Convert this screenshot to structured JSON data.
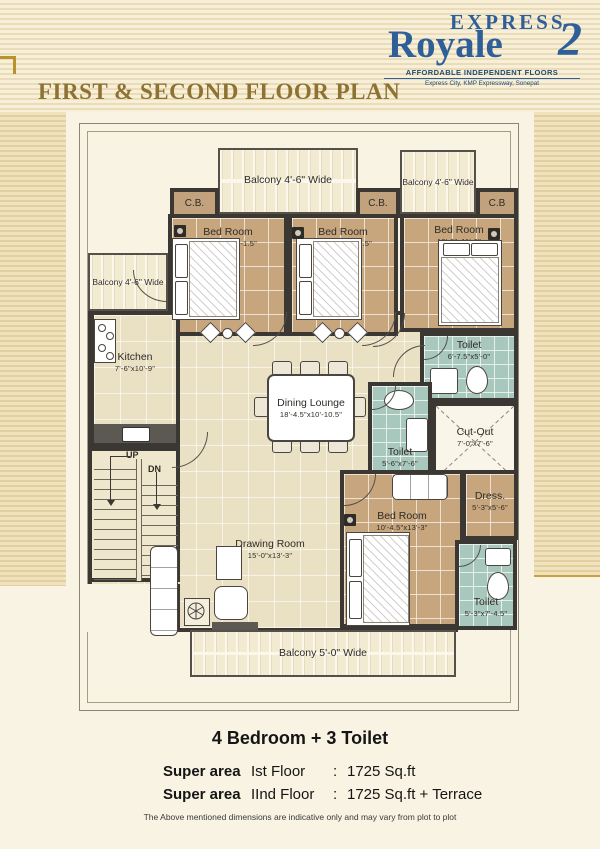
{
  "brand": {
    "line1": "EXPRESS",
    "line2": "Royale",
    "line2_suffix": "2",
    "tagline": "AFFORDABLE INDEPENDENT FLOORS",
    "subtext": "Express City, KMP Expressway, Sonepat",
    "color": "#2f5f98"
  },
  "page_title": "FIRST & SECOND FLOOR PLAN",
  "title_color": "#8d7231",
  "plan": {
    "balconies": {
      "top_center": "Balcony 4'-6\" Wide",
      "top_right": "Balcony 4'-6\" Wide",
      "left": "Balcony 4'-6\" Wide",
      "bottom": "Balcony 5'-0\" Wide"
    },
    "cupboards": [
      {
        "label": "C.B."
      },
      {
        "label": "C.B."
      },
      {
        "label": "C.B"
      }
    ],
    "rooms": {
      "bedroom1": {
        "name": "Bed Room",
        "dims": "10'-4.5\"x13'-1.5\""
      },
      "bedroom2": {
        "name": "Bed Room",
        "dims": "10'-4.5\"x13'-1.5\""
      },
      "bedroom3": {
        "name": "Bed Room",
        "dims": "10'-0\"x11'-0\""
      },
      "kitchen": {
        "name": "Kitchen",
        "dims": "7'-6\"x10'-9\""
      },
      "dining": {
        "name": "Dining Lounge",
        "dims": "18'-4.5\"x10'-10.5\""
      },
      "toilet_top": {
        "name": "Toilet",
        "dims": "6'-7.5\"x5'-0\""
      },
      "toilet_mid": {
        "name": "Toilet",
        "dims": "5'-6\"x7'-6\""
      },
      "cutout": {
        "name": "Cut-Out",
        "dims": "7'-0\"x7'-6\""
      },
      "bedroom4": {
        "name": "Bed Room",
        "dims": "10'-4.5\"x13'-3\""
      },
      "dress": {
        "name": "Dress.",
        "dims": "5'-3\"x5'-6\""
      },
      "toilet_bottom": {
        "name": "Toilet",
        "dims": "5'-3\"x7'-4.5\""
      },
      "drawing": {
        "name": "Drawing Room",
        "dims": "15'-0\"x13'-3\""
      }
    },
    "stairs": {
      "up": "UP",
      "down": "DN"
    }
  },
  "summary": {
    "headline": "4 Bedroom + 3 Toilet",
    "rows": [
      {
        "label": "Super area",
        "floor": "Ist Floor",
        "sep": ":",
        "value": "1725 Sq.ft"
      },
      {
        "label": "Super area",
        "floor": "IInd Floor",
        "sep": ":",
        "value": "1725 Sq.ft + Terrace"
      }
    ],
    "disclaimer": "The Above mentioned dimensions are indicative only and may vary from plot to plot"
  },
  "colors": {
    "wall": "#3b3733",
    "bedroom_floor": "#c7a67e",
    "living_floor": "#eae1c4",
    "toilet_floor": "#a9c8bd",
    "background_stripe": "#e2d0a2",
    "gold_accent": "#c9a23e"
  }
}
